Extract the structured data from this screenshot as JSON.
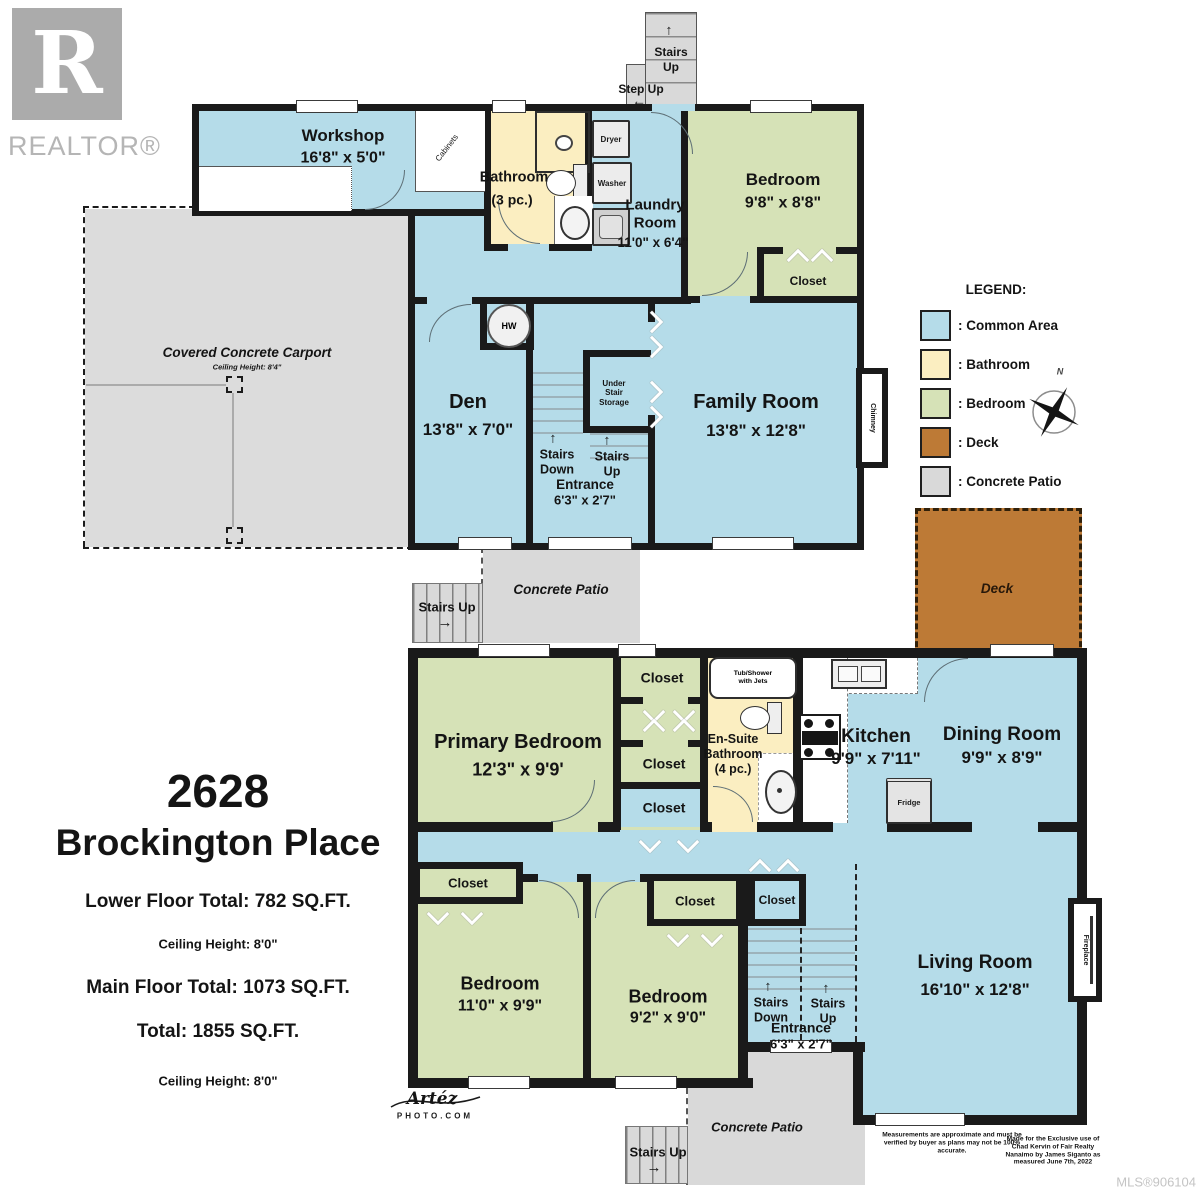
{
  "branding": {
    "realtor_r": "R",
    "realtor_word": "REALTOR®",
    "photo_top": "Artéz",
    "photo_bottom": "PHOTO.COM",
    "mls": "MLS®906104"
  },
  "title_block": {
    "address_line1": "2628",
    "address_line2": "Brockington Place",
    "lower_total": "Lower Floor Total: 782 SQ.FT.",
    "lower_ceiling": "Ceiling Height: 8'0\"",
    "main_total": "Main Floor Total: 1073 SQ.FT.",
    "grand_total": "Total: 1855 SQ.FT.",
    "main_ceiling": "Ceiling Height: 8'0\""
  },
  "legend": {
    "title": "LEGEND:",
    "compass_n": "N",
    "items": [
      {
        "label": ": Common Area",
        "color": "#b5dce9"
      },
      {
        "label": ": Bathroom",
        "color": "#fbeec1"
      },
      {
        "label": ": Bedroom",
        "color": "#d6e2b7"
      },
      {
        "label": ": Deck",
        "color": "#bd7a36"
      },
      {
        "label": ": Concrete Patio",
        "color": "#d9d9d9"
      }
    ]
  },
  "colors": {
    "common": "#b5dce9",
    "bathroom": "#fbeec1",
    "bedroom": "#d6e2b7",
    "deck": "#bd7a36",
    "patio": "#d9d9d9",
    "wall": "#1a1a1a"
  },
  "icons": {
    "arrow_up": "↑",
    "arrow_left": "←",
    "arrow_right": "→"
  },
  "shared": {
    "closet": "Closet",
    "stairs": "Stairs",
    "up": "Up",
    "down": "Down",
    "stairs_up": "Stairs Up",
    "step_up": "Step Up",
    "entrance": "Entrance",
    "entrance_dims": "6'3\" x 2'7\"",
    "concrete_patio": "Concrete Patio"
  },
  "lower_floor": {
    "workshop_name": "Workshop",
    "workshop_dims": "16'8\" x 5'0\"",
    "cabinets": "Cabinets",
    "bathroom_name": "Bathroom",
    "bathroom_pc": "(3 pc.)",
    "laundry_name": "Laundry\nRoom",
    "laundry_dims": "11'0\" x 6'4\"",
    "dryer": "Dryer",
    "washer": "Washer",
    "bedroom_name": "Bedroom",
    "bedroom_dims": "9'8\" x 8'8\"",
    "carport_name": "Covered Concrete Carport",
    "carport_ceiling": "Ceiling Height: 8'4\"",
    "den_name": "Den",
    "den_dims": "13'8\" x 7'0\"",
    "hw": "HW",
    "under_stair": "Under\nStair\nStorage",
    "family_name": "Family Room",
    "family_dims": "13'8\" x 12'8\"",
    "chimney": "Chimney",
    "deck": "Deck"
  },
  "main_floor": {
    "primary_name": "Primary Bedroom",
    "primary_dims": "12'3\" x 9'9'",
    "tub": "Tub/Shower\nwith Jets",
    "ensuite": "En-Suite\nBathroom\n(4 pc.)",
    "kitchen_name": "Kitchen",
    "kitchen_dims": "9'9\" x 7'11\"",
    "fridge": "Fridge",
    "dining_name": "Dining Room",
    "dining_dims": "9'9\" x 8'9\"",
    "living_name": "Living Room",
    "living_dims": "16'10\" x 12'8\"",
    "fireplace": "Fireplace",
    "bedroom2_name": "Bedroom",
    "bedroom2_dims": "11'0\" x 9'9\"",
    "bedroom3_name": "Bedroom",
    "bedroom3_dims": "9'2\" x 9'0\""
  },
  "disclaimer": {
    "left": "Measurements are approximate and must be verified by buyer as plans may not be 100% accurate.",
    "right": "Made for the Exclusive use of Chad Kervin of Fair Realty Nanaimo by James Siganto as measured June 7th, 2022"
  }
}
